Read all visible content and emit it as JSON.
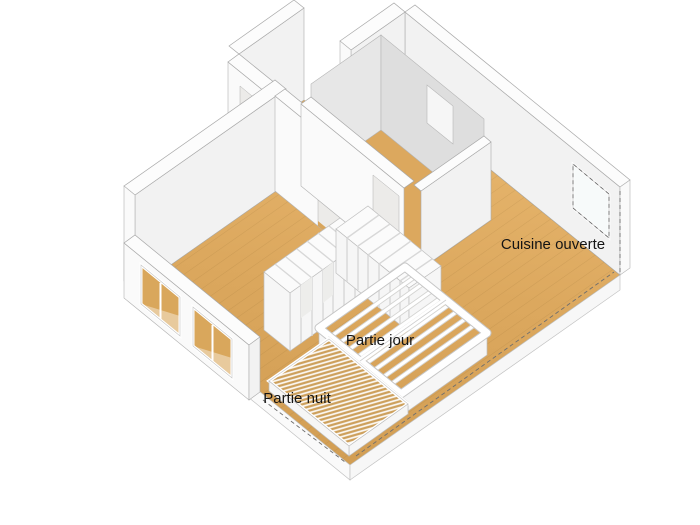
{
  "scene": {
    "view": "axonometric-3d-floor-plan",
    "labels": {
      "kitchen": "Cuisine ouverte",
      "day_area": "Partie jour",
      "night_area": "Partie nuit"
    },
    "colors": {
      "background": "#FFFFFF",
      "floor_wood": "#DCA85E",
      "floor_wood_dark": "#D29E54",
      "floor_wood_light": "#E8B76F",
      "wall_white": "#FCFCFC",
      "wall_inner": "#F2F2F2",
      "wall_gray_interior": "#E2E2E2",
      "furniture_white": "#F6F6F6",
      "section_cut_dash": "#6E6E6E",
      "label_text": "#141414"
    }
  }
}
